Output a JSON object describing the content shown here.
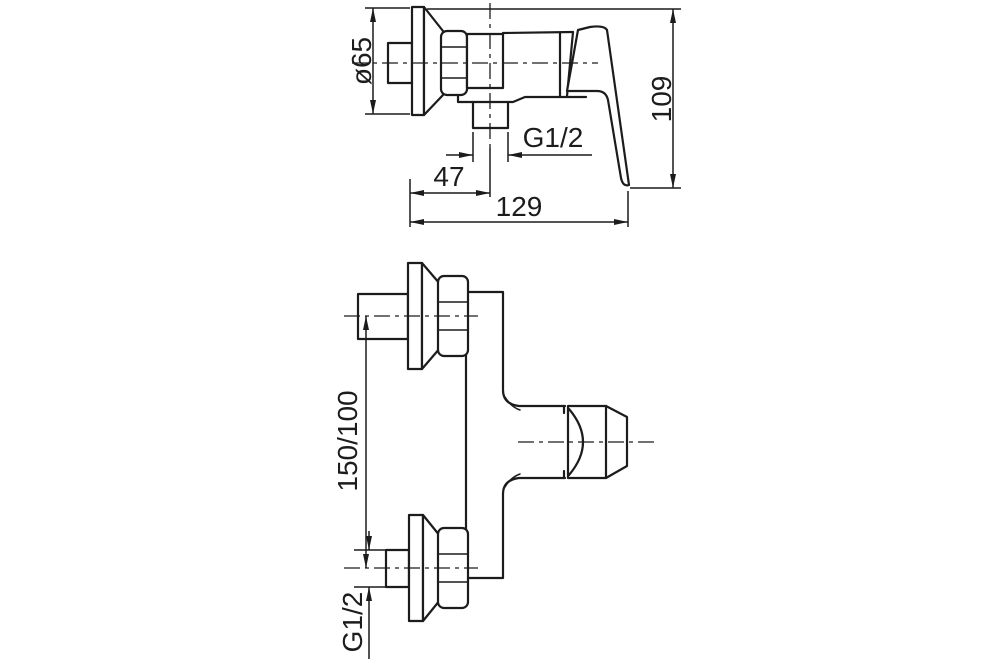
{
  "colors": {
    "line": "#1c1c1c",
    "background": "#ffffff"
  },
  "top_view": {
    "dim_diameter": "ø65",
    "dim_thread": "G1/2",
    "dim_offset": "47",
    "dim_width": "129",
    "dim_height": "109"
  },
  "bottom_view": {
    "dim_spacing": "150/100",
    "dim_thread": "G1/2"
  }
}
